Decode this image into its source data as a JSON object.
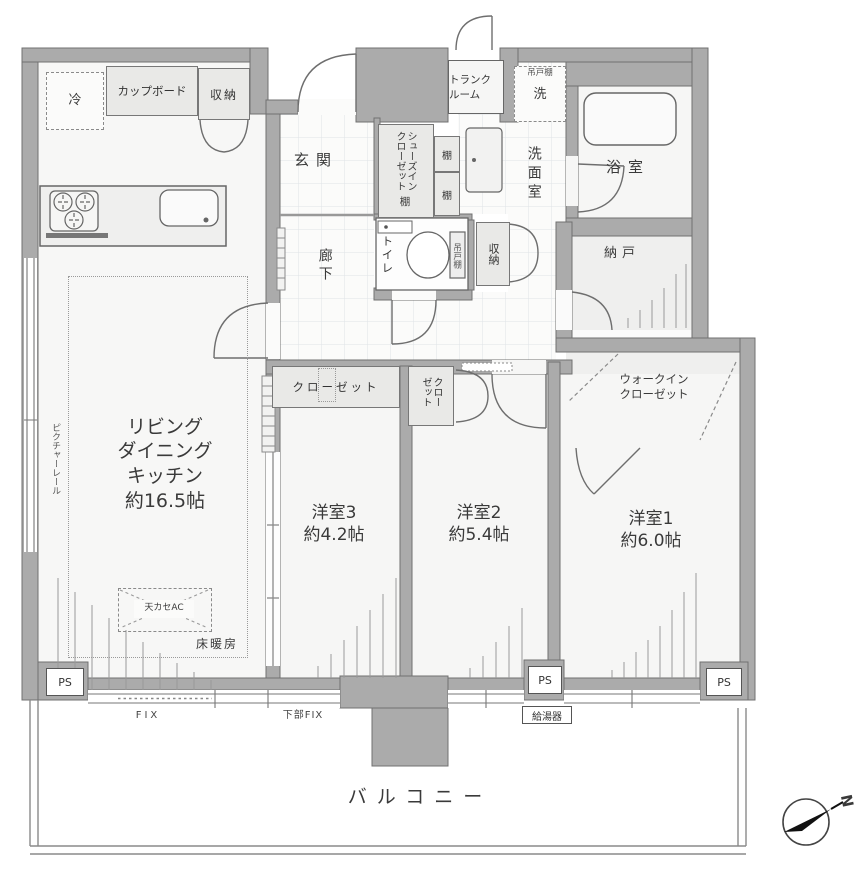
{
  "colors": {
    "wall": "#ababab",
    "wall_edge": "#707070",
    "room": "#f6f6f5",
    "fixture_fill": "#e9e9e7",
    "tile_line": "#dfe3e7",
    "line": "#555555"
  },
  "rooms": {
    "ldk_label": "リビング\nダイニング\nキッチン\n約16.5帖",
    "bedroom3": "洋室3\n約4.2帖",
    "bedroom2": "洋室2\n約5.4帖",
    "bedroom1": "洋室1\n約6.0帖",
    "entrance": "玄関",
    "corridor": "廊下",
    "washroom": "洗面室",
    "bathroom": "浴室",
    "storeroom": "納戸",
    "toilet": "トイレ",
    "balcony": "バルコニー",
    "walk_in_closet": "ウォークイン\nクローゼット",
    "trunk_room": "トランク\nルーム"
  },
  "fixtures": {
    "refrigerator": "冷",
    "cupboard": "カップボード",
    "kitchen_storage": "収納",
    "shoes_in_closet": "シューズインクローゼット",
    "shoes_closet_shelf": "棚",
    "shelf_upper": "棚",
    "shelf_lower": "棚",
    "hanging_cupboard_laundry": "吊戸棚",
    "washer": "洗",
    "hanging_cupboard_toilet": "吊戸棚",
    "hall_storage": "収納",
    "closet_b3": "クローゼット",
    "closet_b2": "クローゼット",
    "ps_left": "PS",
    "ps_center": "PS",
    "ps_right": "PS",
    "water_heater": "給湯器"
  },
  "annotations": {
    "picture_rail": "ピクチャーレール",
    "floor_heating": "床暖房",
    "ceiling_ac": "天カセAC",
    "fix": "FIX",
    "lower_fix": "下部FIX",
    "compass_north": "N"
  }
}
